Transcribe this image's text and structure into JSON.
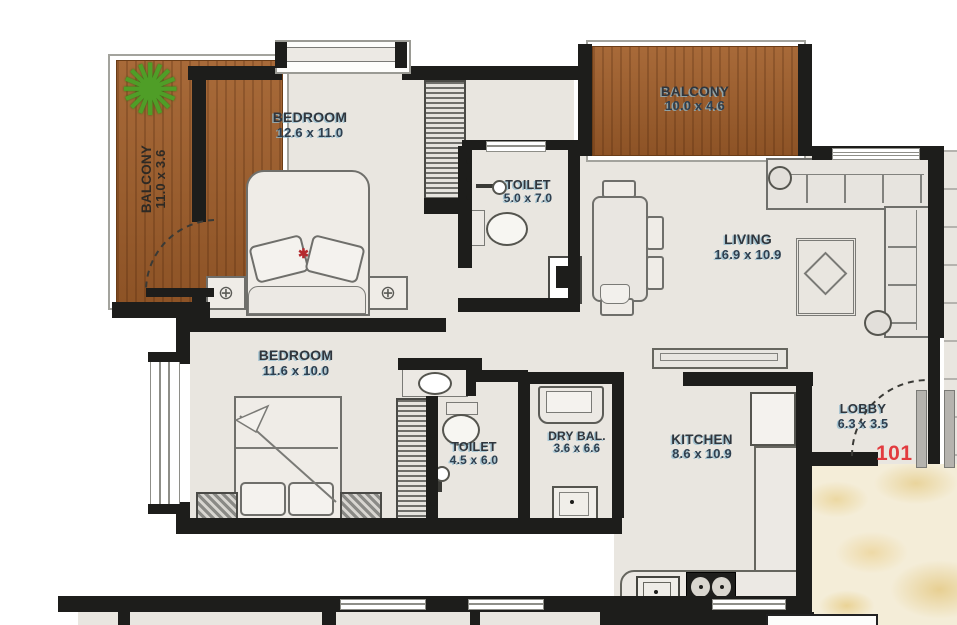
{
  "plan": {
    "unit_number": "101",
    "rooms": {
      "balcony1": {
        "label": "BALCONY",
        "dims": "11.0 x 3.6"
      },
      "bedroom1": {
        "label": "BEDROOM",
        "dims": "12.6 x 11.0"
      },
      "toilet1": {
        "label": "TOILET",
        "dims": "5.0 x 7.0"
      },
      "balcony2": {
        "label": "BALCONY",
        "dims": "10.0 x 4.6"
      },
      "living": {
        "label": "LIVING",
        "dims": "16.9 x 10.9"
      },
      "bedroom2": {
        "label": "BEDROOM",
        "dims": "11.6 x 10.0"
      },
      "toilet2": {
        "label": "TOILET",
        "dims": "4.5 x 6.0"
      },
      "dry_balcony": {
        "label": "DRY BAL.",
        "dims": "3.6 x 6.6"
      },
      "kitchen": {
        "label": "KITCHEN",
        "dims": "8.6 x 10.9"
      },
      "lobby": {
        "label": "LOBBY",
        "dims": "6.3 x 3.5"
      }
    },
    "icons": {
      "plant": "✺",
      "nightstand_cross": "⊕",
      "bed_star": "✱"
    },
    "colors": {
      "wall": "#1d1d1b",
      "floor": "#e9e6e0",
      "wood": "#9c5e2f",
      "marble": "#f4edd8",
      "unit_number_red": "#e23b3f",
      "label_text": "#30363d"
    }
  }
}
